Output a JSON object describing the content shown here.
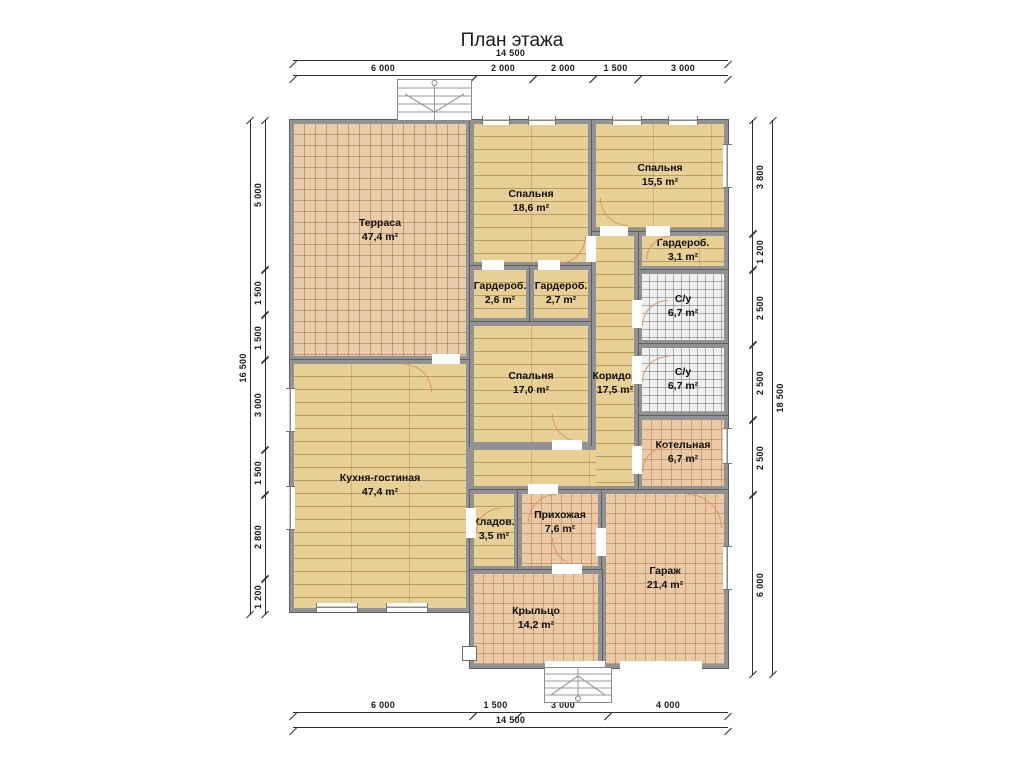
{
  "title": "План этажа",
  "rooms": {
    "terrace": {
      "name": "Терраса",
      "area": "47,4 m²"
    },
    "kitchen_living": {
      "name": "Кухня-гостиная",
      "area": "47,4 m²"
    },
    "bedroom_18": {
      "name": "Спальня",
      "area": "18,6 m²"
    },
    "bedroom_15": {
      "name": "Спальня",
      "area": "15,5 m²"
    },
    "bedroom_17": {
      "name": "Спальня",
      "area": "17,0 m²"
    },
    "wardrobe_26": {
      "name": "Гардероб.",
      "area": "2,6 m²"
    },
    "wardrobe_27": {
      "name": "Гардероб.",
      "area": "2,7 m²"
    },
    "wardrobe_31": {
      "name": "Гардероб.",
      "area": "3,1 m²"
    },
    "bathroom_top": {
      "name": "С/у",
      "area": "6,7 m²"
    },
    "bathroom_bottom": {
      "name": "С/у",
      "area": "6,7 m²"
    },
    "boiler": {
      "name": "Котельная",
      "area": "6,7 m²"
    },
    "corridor": {
      "name": "Коридор",
      "area": "17,5 m²"
    },
    "storage": {
      "name": "Кладов.",
      "area": "3,5 m²"
    },
    "hallway": {
      "name": "Прихожая",
      "area": "7,6 m²"
    },
    "garage": {
      "name": "Гараж",
      "area": "21,4 m²"
    },
    "porch": {
      "name": "Крыльцо",
      "area": "14,2 m²"
    }
  },
  "dimensions": {
    "top_total": "14 500",
    "top_segments": [
      "6 000",
      "2 000",
      "2 000",
      "1 500",
      "3 000"
    ],
    "bottom_segments": [
      "6 000",
      "1 500",
      "3 000",
      "4 000"
    ],
    "bottom_total": "14 500",
    "left_total": "16 500",
    "left_segments": [
      "5 000",
      "1 500",
      "1 500",
      "3 000",
      "1 500",
      "2 800",
      "1 200"
    ],
    "right_segments": [
      "3 800",
      "1 200",
      "2 500",
      "2 500",
      "2 500",
      "6 000"
    ],
    "right_total": "18 500"
  },
  "colors": {
    "wood_floor": "#e7cf96",
    "tile_floor": "#eacaa6",
    "bath_tile": "#f0f0ed",
    "wall": "#929292",
    "door_arc": "#dd8a55"
  }
}
